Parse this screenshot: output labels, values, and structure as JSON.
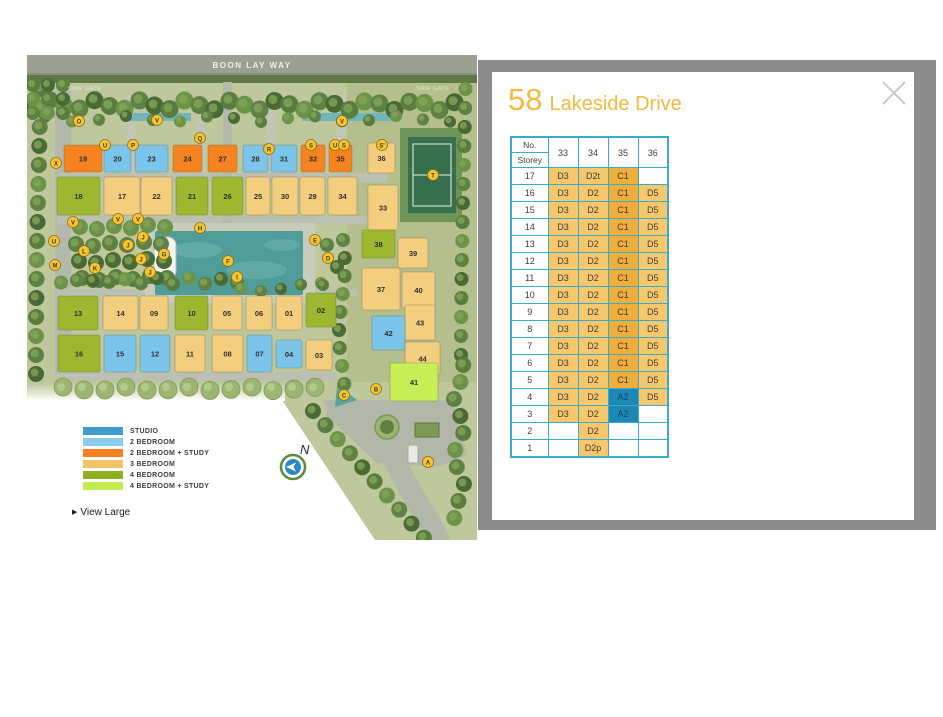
{
  "map": {
    "road_label": "BOON LAY WAY",
    "side_gate_left": "SIDE GATE",
    "side_gate_right": "SIDE GATE",
    "compass_label": "N",
    "view_large_label": "View Large",
    "view_large_icon": "▶",
    "legend": [
      {
        "label": "STUDIO",
        "color": "#3E9ED2"
      },
      {
        "label": "2 BEDROOM",
        "color": "#8ACBEE"
      },
      {
        "label": "2 BEDROOM + STUDY",
        "color": "#F5821F"
      },
      {
        "label": "3 BEDROOM",
        "color": "#F1C469"
      },
      {
        "label": "4 BEDROOM",
        "color": "#8FAF21"
      },
      {
        "label": "4 BEDROOM + STUDY",
        "color": "#C2EC4E"
      }
    ],
    "unit_colors": {
      "2br": "#7CC5EA",
      "2br_study": "#F5831F",
      "3br": "#F3CE7F",
      "4br": "#9DB830",
      "4br_study": "#C7EE55"
    },
    "buildings": [
      {
        "n": "19",
        "t": "2br_study",
        "x": 37,
        "y": 90,
        "w": 38,
        "h": 27
      },
      {
        "n": "20",
        "t": "2br",
        "x": 77,
        "y": 90,
        "w": 27,
        "h": 27
      },
      {
        "n": "23",
        "t": "2br",
        "x": 108,
        "y": 90,
        "w": 33,
        "h": 27
      },
      {
        "n": "24",
        "t": "2br_study",
        "x": 146,
        "y": 90,
        "w": 29,
        "h": 27
      },
      {
        "n": "27",
        "t": "2br_study",
        "x": 181,
        "y": 90,
        "w": 29,
        "h": 27
      },
      {
        "n": "28",
        "t": "2br",
        "x": 216,
        "y": 90,
        "w": 25,
        "h": 27
      },
      {
        "n": "31",
        "t": "2br",
        "x": 244,
        "y": 90,
        "w": 26,
        "h": 27
      },
      {
        "n": "32",
        "t": "2br_study",
        "x": 274,
        "y": 90,
        "w": 24,
        "h": 27
      },
      {
        "n": "35",
        "t": "2br_study",
        "x": 302,
        "y": 90,
        "w": 23,
        "h": 27
      },
      {
        "n": "36",
        "t": "3br",
        "x": 341,
        "y": 88,
        "w": 27,
        "h": 30
      },
      {
        "n": "18",
        "t": "4br",
        "x": 30,
        "y": 122,
        "w": 43,
        "h": 38
      },
      {
        "n": "17",
        "t": "3br",
        "x": 77,
        "y": 122,
        "w": 36,
        "h": 38
      },
      {
        "n": "22",
        "t": "3br",
        "x": 114,
        "y": 122,
        "w": 31,
        "h": 38
      },
      {
        "n": "21",
        "t": "4br",
        "x": 149,
        "y": 122,
        "w": 32,
        "h": 38
      },
      {
        "n": "26",
        "t": "4br",
        "x": 185,
        "y": 122,
        "w": 31,
        "h": 38
      },
      {
        "n": "25",
        "t": "3br",
        "x": 219,
        "y": 122,
        "w": 24,
        "h": 38
      },
      {
        "n": "30",
        "t": "3br",
        "x": 245,
        "y": 122,
        "w": 26,
        "h": 38
      },
      {
        "n": "29",
        "t": "3br",
        "x": 273,
        "y": 122,
        "w": 25,
        "h": 38
      },
      {
        "n": "34",
        "t": "3br",
        "x": 301,
        "y": 122,
        "w": 29,
        "h": 38
      },
      {
        "n": "33",
        "t": "3br",
        "x": 341,
        "y": 130,
        "w": 30,
        "h": 45
      },
      {
        "n": "13",
        "t": "4br",
        "x": 31,
        "y": 241,
        "w": 40,
        "h": 34
      },
      {
        "n": "14",
        "t": "3br",
        "x": 76,
        "y": 241,
        "w": 35,
        "h": 34
      },
      {
        "n": "09",
        "t": "3br",
        "x": 113,
        "y": 241,
        "w": 28,
        "h": 34
      },
      {
        "n": "10",
        "t": "4br",
        "x": 148,
        "y": 241,
        "w": 33,
        "h": 34
      },
      {
        "n": "05",
        "t": "3br",
        "x": 185,
        "y": 241,
        "w": 30,
        "h": 34
      },
      {
        "n": "06",
        "t": "3br",
        "x": 219,
        "y": 241,
        "w": 26,
        "h": 34
      },
      {
        "n": "01",
        "t": "3br",
        "x": 249,
        "y": 241,
        "w": 26,
        "h": 34
      },
      {
        "n": "02",
        "t": "4br",
        "x": 279,
        "y": 238,
        "w": 30,
        "h": 34
      },
      {
        "n": "16",
        "t": "4br",
        "x": 31,
        "y": 280,
        "w": 42,
        "h": 37
      },
      {
        "n": "15",
        "t": "2br",
        "x": 77,
        "y": 280,
        "w": 32,
        "h": 37
      },
      {
        "n": "12",
        "t": "2br",
        "x": 113,
        "y": 280,
        "w": 30,
        "h": 37
      },
      {
        "n": "11",
        "t": "3br",
        "x": 148,
        "y": 280,
        "w": 30,
        "h": 37
      },
      {
        "n": "08",
        "t": "3br",
        "x": 185,
        "y": 280,
        "w": 31,
        "h": 37
      },
      {
        "n": "07",
        "t": "2br",
        "x": 220,
        "y": 280,
        "w": 25,
        "h": 37
      },
      {
        "n": "04",
        "t": "2br",
        "x": 249,
        "y": 285,
        "w": 26,
        "h": 28
      },
      {
        "n": "03",
        "t": "3br",
        "x": 279,
        "y": 285,
        "w": 26,
        "h": 30
      },
      {
        "n": "38",
        "t": "4br",
        "x": 335,
        "y": 175,
        "w": 33,
        "h": 28
      },
      {
        "n": "39",
        "t": "3br",
        "x": 371,
        "y": 183,
        "w": 30,
        "h": 30
      },
      {
        "n": "37",
        "t": "3br",
        "x": 335,
        "y": 213,
        "w": 38,
        "h": 42
      },
      {
        "n": "40",
        "t": "3br",
        "x": 375,
        "y": 217,
        "w": 33,
        "h": 36
      },
      {
        "n": "43",
        "t": "3br",
        "x": 378,
        "y": 250,
        "w": 30,
        "h": 35
      },
      {
        "n": "42",
        "t": "2br",
        "x": 345,
        "y": 261,
        "w": 33,
        "h": 34
      },
      {
        "n": "44",
        "t": "3br",
        "x": 378,
        "y": 287,
        "w": 35,
        "h": 33
      },
      {
        "n": "41",
        "t": "4br_study",
        "x": 363,
        "y": 308,
        "w": 48,
        "h": 38
      }
    ],
    "markers": [
      {
        "l": "O",
        "x": 52,
        "y": 66
      },
      {
        "l": "V",
        "x": 130,
        "y": 65
      },
      {
        "l": "V",
        "x": 315,
        "y": 66
      },
      {
        "l": "U",
        "x": 78,
        "y": 90
      },
      {
        "l": "P",
        "x": 106,
        "y": 90
      },
      {
        "l": "Q",
        "x": 173,
        "y": 83
      },
      {
        "l": "R",
        "x": 242,
        "y": 94
      },
      {
        "l": "S",
        "x": 284,
        "y": 90
      },
      {
        "l": "U",
        "x": 308,
        "y": 90
      },
      {
        "l": "S",
        "x": 317,
        "y": 90
      },
      {
        "l": "S'",
        "x": 355,
        "y": 90
      },
      {
        "l": "X",
        "x": 29,
        "y": 108
      },
      {
        "l": "T",
        "x": 406,
        "y": 120
      },
      {
        "l": "V",
        "x": 46,
        "y": 167
      },
      {
        "l": "H",
        "x": 173,
        "y": 173
      },
      {
        "l": "V",
        "x": 91,
        "y": 164
      },
      {
        "l": "V",
        "x": 111,
        "y": 164
      },
      {
        "l": "U",
        "x": 27,
        "y": 186
      },
      {
        "l": "M",
        "x": 28,
        "y": 210
      },
      {
        "l": "L",
        "x": 57,
        "y": 196
      },
      {
        "l": "K",
        "x": 68,
        "y": 213
      },
      {
        "l": "J",
        "x": 101,
        "y": 190
      },
      {
        "l": "J",
        "x": 116,
        "y": 182
      },
      {
        "l": "J",
        "x": 114,
        "y": 204
      },
      {
        "l": "J",
        "x": 123,
        "y": 217
      },
      {
        "l": "G",
        "x": 137,
        "y": 199
      },
      {
        "l": "F",
        "x": 201,
        "y": 206
      },
      {
        "l": "I",
        "x": 210,
        "y": 222
      },
      {
        "l": "E",
        "x": 288,
        "y": 185
      },
      {
        "l": "D",
        "x": 301,
        "y": 203
      },
      {
        "l": "C",
        "x": 317,
        "y": 340
      },
      {
        "l": "B",
        "x": 349,
        "y": 334
      },
      {
        "l": "A",
        "x": 401,
        "y": 407
      }
    ]
  },
  "panel": {
    "title_number": "58",
    "title_name": "Lakeside Drive",
    "colors": {
      "light": "#F6C76B",
      "dark": "#EFAD3B",
      "blue": "#1C86B4",
      "border": "#3AACCB"
    },
    "table": {
      "header_no": "No.",
      "header_storey": "Storey",
      "columns": [
        "33",
        "34",
        "35",
        "36"
      ],
      "rows": [
        {
          "storey": "17",
          "cells": [
            {
              "v": "D3",
              "t": "light"
            },
            {
              "v": "D2t",
              "t": "light"
            },
            {
              "v": "C1",
              "t": "dark"
            },
            {
              "v": "",
              "t": "empty"
            }
          ]
        },
        {
          "storey": "16",
          "cells": [
            {
              "v": "D3",
              "t": "light"
            },
            {
              "v": "D2",
              "t": "light"
            },
            {
              "v": "C1",
              "t": "dark"
            },
            {
              "v": "D5",
              "t": "light"
            }
          ]
        },
        {
          "storey": "15",
          "cells": [
            {
              "v": "D3",
              "t": "light"
            },
            {
              "v": "D2",
              "t": "light"
            },
            {
              "v": "C1",
              "t": "dark"
            },
            {
              "v": "D5",
              "t": "light"
            }
          ]
        },
        {
          "storey": "14",
          "cells": [
            {
              "v": "D3",
              "t": "light"
            },
            {
              "v": "D2",
              "t": "light"
            },
            {
              "v": "C1",
              "t": "dark"
            },
            {
              "v": "D5",
              "t": "light"
            }
          ]
        },
        {
          "storey": "13",
          "cells": [
            {
              "v": "D3",
              "t": "light"
            },
            {
              "v": "D2",
              "t": "light"
            },
            {
              "v": "C1",
              "t": "dark"
            },
            {
              "v": "D5",
              "t": "light"
            }
          ]
        },
        {
          "storey": "12",
          "cells": [
            {
              "v": "D3",
              "t": "light"
            },
            {
              "v": "D2",
              "t": "light"
            },
            {
              "v": "C1",
              "t": "dark"
            },
            {
              "v": "D5",
              "t": "light"
            }
          ]
        },
        {
          "storey": "11",
          "cells": [
            {
              "v": "D3",
              "t": "light"
            },
            {
              "v": "D2",
              "t": "light"
            },
            {
              "v": "C1",
              "t": "dark"
            },
            {
              "v": "D5",
              "t": "light"
            }
          ]
        },
        {
          "storey": "10",
          "cells": [
            {
              "v": "D3",
              "t": "light"
            },
            {
              "v": "D2",
              "t": "light"
            },
            {
              "v": "C1",
              "t": "dark"
            },
            {
              "v": "D5",
              "t": "light"
            }
          ]
        },
        {
          "storey": "9",
          "cells": [
            {
              "v": "D3",
              "t": "light"
            },
            {
              "v": "D2",
              "t": "light"
            },
            {
              "v": "C1",
              "t": "dark"
            },
            {
              "v": "D5",
              "t": "light"
            }
          ]
        },
        {
          "storey": "8",
          "cells": [
            {
              "v": "D3",
              "t": "light"
            },
            {
              "v": "D2",
              "t": "light"
            },
            {
              "v": "C1",
              "t": "dark"
            },
            {
              "v": "D5",
              "t": "light"
            }
          ]
        },
        {
          "storey": "7",
          "cells": [
            {
              "v": "D3",
              "t": "light"
            },
            {
              "v": "D2",
              "t": "light"
            },
            {
              "v": "C1",
              "t": "dark"
            },
            {
              "v": "D5",
              "t": "light"
            }
          ]
        },
        {
          "storey": "6",
          "cells": [
            {
              "v": "D3",
              "t": "light"
            },
            {
              "v": "D2",
              "t": "light"
            },
            {
              "v": "C1",
              "t": "dark"
            },
            {
              "v": "D5",
              "t": "light"
            }
          ]
        },
        {
          "storey": "5",
          "cells": [
            {
              "v": "D3",
              "t": "light"
            },
            {
              "v": "D2",
              "t": "light"
            },
            {
              "v": "C1",
              "t": "dark"
            },
            {
              "v": "D5",
              "t": "light"
            }
          ]
        },
        {
          "storey": "4",
          "cells": [
            {
              "v": "D3",
              "t": "light"
            },
            {
              "v": "D2",
              "t": "light"
            },
            {
              "v": "A2",
              "t": "blue"
            },
            {
              "v": "D5",
              "t": "light"
            }
          ]
        },
        {
          "storey": "3",
          "cells": [
            {
              "v": "D3",
              "t": "light"
            },
            {
              "v": "D2",
              "t": "light"
            },
            {
              "v": "A2",
              "t": "blue"
            },
            {
              "v": "",
              "t": "empty"
            }
          ]
        },
        {
          "storey": "2",
          "cells": [
            {
              "v": "",
              "t": "empty"
            },
            {
              "v": "D2",
              "t": "light"
            },
            {
              "v": "",
              "t": "empty"
            },
            {
              "v": "",
              "t": "empty"
            }
          ]
        },
        {
          "storey": "1",
          "cells": [
            {
              "v": "",
              "t": "empty"
            },
            {
              "v": "D2p",
              "t": "light"
            },
            {
              "v": "",
              "t": "empty"
            },
            {
              "v": "",
              "t": "empty"
            }
          ]
        }
      ]
    }
  }
}
